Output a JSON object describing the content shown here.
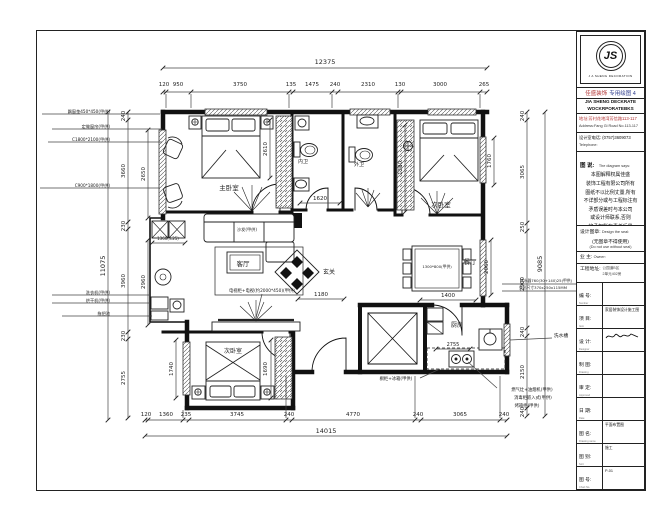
{
  "title_block": {
    "logo_initials": "JS",
    "logo_ring_text": "J A SHENG DECORATION",
    "brand_cn_a": "佳盛装饰",
    "brand_cn_b": "专用绘图 4",
    "brand_en1": "JIA SHENG DECKRATE",
    "brand_en2": "WOCKRPORATEBKS",
    "address_cn": "地址:芳村花地湾芳信路113-117",
    "address_en": "Address:Fang Gi Road No.113-117",
    "phone_cn": "设计室电话: (0757)3609073",
    "phone_en": "Telephone:",
    "notes_title_cn": "图 说:",
    "notes_title_en": "The diagram says:",
    "notes_lines": [
      "本图解释权属佳盛",
      "装饰工程有限公司所有",
      "图纸不以比例丈量,所有",
      "不详部分或与工程标注有",
      "矛盾误差时与本公司",
      "或设计师联系,否则",
      "将承担所有责任后果"
    ],
    "stamp_label": "设计图章:",
    "stamp_label_en": "Design the seal:",
    "stamp_center": "(无图章不得使用)",
    "stamp_center_en": "(Do not use without seal)",
    "owner_label": "业 主:",
    "owner_en": "Owner:",
    "site_label": "工程地址:",
    "site_lines": [
      "公园道B区",
      "2单元402房"
    ],
    "rows": [
      {
        "label": "编 号:",
        "en": "Number",
        "value": ""
      },
      {
        "label": "项 目:",
        "en": "Item",
        "value": "家居装饰设计施工图"
      },
      {
        "label": "设 计:",
        "en": "Designer",
        "value": "",
        "sig": true
      },
      {
        "label": "制 图:",
        "en": "Drawing",
        "value": ""
      },
      {
        "label": "审 定:",
        "en": "Approved",
        "value": ""
      },
      {
        "label": "日 期:",
        "en": "Date",
        "value": ""
      },
      {
        "label": "图 名:",
        "en": "Drawing name",
        "value": "平面布置图"
      },
      {
        "label": "图 别:",
        "en": "Sort",
        "value": "施工"
      },
      {
        "label": "图 号:",
        "en": "Chart No.",
        "value": "P-01"
      }
    ]
  },
  "plan": {
    "rooms": [
      "主卧室",
      "次卧室",
      "次卧室",
      "客厅",
      "餐厅",
      "厨房",
      "玄关",
      "内卫",
      "外卫"
    ],
    "texts": [
      {
        "t": "12375",
        "x": 325,
        "y": 64,
        "s": 6.5,
        "n": "dim-overall-top"
      },
      {
        "t": "120",
        "x": 164,
        "y": 86
      },
      {
        "t": "950",
        "x": 178,
        "y": 86
      },
      {
        "t": "3750",
        "x": 240,
        "y": 86
      },
      {
        "t": "135",
        "x": 291,
        "y": 86
      },
      {
        "t": "1475",
        "x": 312,
        "y": 86
      },
      {
        "t": "240",
        "x": 335,
        "y": 86
      },
      {
        "t": "2310",
        "x": 368,
        "y": 86
      },
      {
        "t": "130",
        "x": 400,
        "y": 86
      },
      {
        "t": "3000",
        "x": 440,
        "y": 86
      },
      {
        "t": "265",
        "x": 484,
        "y": 86
      },
      {
        "t": "14015",
        "x": 326,
        "y": 433,
        "s": 6.5,
        "n": "dim-overall-bottom"
      },
      {
        "t": "120",
        "x": 146,
        "y": 416
      },
      {
        "t": "1360",
        "x": 166,
        "y": 416
      },
      {
        "t": "235",
        "x": 186,
        "y": 416
      },
      {
        "t": "3745",
        "x": 237,
        "y": 416
      },
      {
        "t": "240",
        "x": 289,
        "y": 416
      },
      {
        "t": "4770",
        "x": 353,
        "y": 416
      },
      {
        "t": "240",
        "x": 418,
        "y": 416
      },
      {
        "t": "3065",
        "x": 460,
        "y": 416
      },
      {
        "t": "240",
        "x": 504,
        "y": 416
      },
      {
        "t": "11075",
        "x": 105,
        "y": 266,
        "r": -90,
        "s": 6.5,
        "n": "dim-overall-left"
      },
      {
        "t": "240",
        "x": 125,
        "y": 116,
        "r": -90
      },
      {
        "t": "3660",
        "x": 125,
        "y": 171,
        "r": -90
      },
      {
        "t": "230",
        "x": 125,
        "y": 226,
        "r": -90
      },
      {
        "t": "3960",
        "x": 125,
        "y": 281,
        "r": -90
      },
      {
        "t": "230",
        "x": 125,
        "y": 336,
        "r": -90
      },
      {
        "t": "2755",
        "x": 125,
        "y": 378,
        "r": -90
      },
      {
        "t": "2650",
        "x": 145,
        "y": 174,
        "r": -90
      },
      {
        "t": "2960",
        "x": 145,
        "y": 282,
        "r": -90
      },
      {
        "t": "9085",
        "x": 542,
        "y": 264,
        "r": -90,
        "s": 6.5,
        "n": "dim-overall-right"
      },
      {
        "t": "240",
        "x": 524,
        "y": 116,
        "r": -90
      },
      {
        "t": "3065",
        "x": 524,
        "y": 172,
        "r": -90
      },
      {
        "t": "250",
        "x": 524,
        "y": 227,
        "r": -90
      },
      {
        "t": "2900",
        "x": 524,
        "y": 284,
        "r": -90
      },
      {
        "t": "240",
        "x": 524,
        "y": 332,
        "r": -90
      },
      {
        "t": "2150",
        "x": 524,
        "y": 372,
        "r": -90
      },
      {
        "t": "240",
        "x": 524,
        "y": 412,
        "r": -90
      },
      {
        "t": "1760",
        "x": 491,
        "y": 161,
        "r": -90
      },
      {
        "t": "2060",
        "x": 488,
        "y": 267,
        "r": -90
      },
      {
        "t": "2610",
        "x": 267,
        "y": 149,
        "r": -90
      },
      {
        "t": "1380",
        "x": 402,
        "y": 168,
        "r": -90
      },
      {
        "t": "1620",
        "x": 320,
        "y": 200
      },
      {
        "t": "1180",
        "x": 321,
        "y": 296
      },
      {
        "t": "1400",
        "x": 448,
        "y": 297
      },
      {
        "t": "2755",
        "x": 453,
        "y": 346,
        "s": 5
      },
      {
        "t": "1740",
        "x": 173,
        "y": 369,
        "r": -90
      },
      {
        "t": "1690",
        "x": 267,
        "y": 369,
        "r": -90
      },
      {
        "t": "1360(±25)",
        "x": 168,
        "y": 240,
        "s": 4
      },
      {
        "t": "主卧室",
        "x": 229,
        "y": 190,
        "s": 6.5,
        "n": "room-label-master-bedroom"
      },
      {
        "t": "内卫",
        "x": 303,
        "y": 163,
        "s": 5,
        "n": "room-label-inner-bath"
      },
      {
        "t": "外卫",
        "x": 359,
        "y": 166,
        "s": 5,
        "n": "room-label-outer-bath"
      },
      {
        "t": "次卧室",
        "x": 441,
        "y": 207,
        "s": 6.5,
        "n": "room-label-second-bedroom"
      },
      {
        "t": "客厅",
        "x": 243,
        "y": 266,
        "s": 6.5,
        "n": "room-label-living-room"
      },
      {
        "t": "玄关",
        "x": 329,
        "y": 274,
        "s": 6,
        "n": "room-label-entry"
      },
      {
        "t": "餐厅",
        "x": 470,
        "y": 264,
        "s": 6.5,
        "n": "room-label-dining-room"
      },
      {
        "t": "次卧室",
        "x": 233,
        "y": 353,
        "s": 6,
        "n": "room-label-third-bedroom"
      },
      {
        "t": "厨房",
        "x": 457,
        "y": 327,
        "s": 6,
        "n": "room-label-kitchen"
      },
      {
        "t": "沙发(甲供)",
        "x": 247,
        "y": 231,
        "s": 4.2,
        "n": "sofa-note"
      },
      {
        "t": "1300*800(甲供)",
        "x": 437,
        "y": 268,
        "s": 3.8,
        "n": "dining-table-note"
      },
      {
        "t": "电视柜+电视(约2000*450)(甲供)",
        "x": 262,
        "y": 292,
        "s": 4.3,
        "n": "tv-note"
      },
      {
        "t": "橱柜+冰箱(甲供)",
        "x": 396,
        "y": 380,
        "s": 4.3,
        "n": "cabinet-fridge-note"
      },
      {
        "t": "燃气灶+油烟机(甲供)",
        "x": 532,
        "y": 391,
        "s": 4.3,
        "n": "stove-note"
      },
      {
        "t": "消毒柜嵌入式(甲供)",
        "x": 533,
        "y": 399,
        "s": 4.3,
        "n": "sterilizer-note"
      },
      {
        "t": "烤箱柜(甲供)",
        "x": 527,
        "y": 407,
        "s": 4.3,
        "n": "oven-note"
      },
      {
        "t": "热水器760(30+140)25(甲供)",
        "x": 546,
        "y": 282,
        "s": 3.8,
        "n": "water-heater-note"
      },
      {
        "t": "外形尺寸370x250x115MM",
        "x": 543,
        "y": 289,
        "s": 3.8,
        "n": "water-heater-size-note"
      },
      {
        "t": "洗水槽",
        "x": 561,
        "y": 337,
        "s": 4.8,
        "n": "sink-note"
      },
      {
        "t": "飘窗垫450*450(甲供)",
        "x": 110,
        "y": 113,
        "s": 4.2,
        "a": "e",
        "n": "bay-window-note"
      },
      {
        "t": "定做窗帘(甲供)",
        "x": 110,
        "y": 128,
        "s": 4.2,
        "a": "e",
        "n": "curtain-note"
      },
      {
        "t": "C1800*2100(甲供)",
        "x": 110,
        "y": 141,
        "s": 4.2,
        "a": "e",
        "n": "window-size-note"
      },
      {
        "t": "C900*1800(甲供)",
        "x": 110,
        "y": 187,
        "s": 4.2,
        "a": "e",
        "n": "window-size-note-2"
      },
      {
        "t": "洗衣机(甲供)",
        "x": 110,
        "y": 294,
        "s": 4.2,
        "a": "e",
        "n": "washer-note"
      },
      {
        "t": "烘干机(甲供)",
        "x": 110,
        "y": 302,
        "s": 4.2,
        "a": "e",
        "n": "dryer-note"
      },
      {
        "t": "拖把池",
        "x": 110,
        "y": 315,
        "s": 4.2,
        "a": "e",
        "n": "mop-pool-note"
      }
    ],
    "chains": [
      {
        "line": [
          163,
          68,
          487,
          68
        ],
        "ticks": [
          [
            163,
            68
          ],
          [
            487,
            68
          ]
        ]
      },
      {
        "line": [
          163,
          92,
          487,
          92
        ],
        "ticks": [
          [
            163,
            92
          ],
          [
            166,
            92
          ],
          [
            191,
            92
          ],
          [
            289,
            92
          ],
          [
            293,
            92
          ],
          [
            332,
            92
          ],
          [
            338,
            92
          ],
          [
            398,
            92
          ],
          [
            401,
            92
          ],
          [
            480,
            92
          ],
          [
            487,
            92
          ]
        ]
      },
      {
        "line": [
          145,
          420,
          507,
          420
        ],
        "ticks": [
          [
            145,
            420
          ],
          [
            148,
            420
          ],
          [
            183,
            420
          ],
          [
            189,
            420
          ],
          [
            286,
            420
          ],
          [
            292,
            420
          ],
          [
            415,
            420
          ],
          [
            421,
            420
          ],
          [
            500,
            420
          ],
          [
            507,
            420
          ]
        ]
      },
      {
        "line": [
          145,
          436,
          507,
          436
        ],
        "ticks": [
          [
            145,
            436
          ],
          [
            507,
            436
          ]
        ]
      },
      {
        "line": [
          108,
          112,
          108,
          420
        ],
        "ticks": [
          [
            108,
            112
          ],
          [
            108,
            420
          ]
        ]
      },
      {
        "line": [
          128,
          112,
          128,
          418
        ],
        "ticks": [
          [
            128,
            112
          ],
          [
            128,
            120
          ],
          [
            128,
            222
          ],
          [
            128,
            229
          ],
          [
            128,
            332
          ],
          [
            128,
            339
          ],
          [
            128,
            418
          ]
        ]
      },
      {
        "line": [
          148,
          130,
          148,
          218
        ],
        "ticks": [
          [
            148,
            130
          ],
          [
            148,
            218
          ]
        ]
      },
      {
        "line": [
          148,
          240,
          148,
          325
        ],
        "ticks": [
          [
            148,
            240
          ],
          [
            148,
            325
          ]
        ]
      },
      {
        "line": [
          527,
          112,
          527,
          416
        ],
        "ticks": [
          [
            527,
            112
          ],
          [
            527,
            120
          ],
          [
            527,
            223
          ],
          [
            527,
            231
          ],
          [
            527,
            328
          ],
          [
            527,
            336
          ],
          [
            527,
            408
          ],
          [
            527,
            416
          ]
        ]
      },
      {
        "line": [
          545,
          112,
          545,
          416
        ],
        "ticks": [
          [
            545,
            112
          ],
          [
            545,
            416
          ]
        ]
      },
      {
        "line": [
          494,
          138,
          494,
          185
        ],
        "ticks": [
          [
            494,
            138
          ],
          [
            494,
            185
          ]
        ]
      },
      {
        "line": [
          491,
          240,
          491,
          295
        ],
        "ticks": [
          [
            491,
            240
          ],
          [
            491,
            295
          ]
        ]
      },
      {
        "line": [
          270,
          120,
          270,
          178
        ],
        "ticks": [
          [
            270,
            120
          ],
          [
            270,
            178
          ]
        ]
      },
      {
        "line": [
          405,
          125,
          405,
          212
        ],
        "ticks": [
          [
            405,
            125
          ],
          [
            405,
            212
          ]
        ]
      },
      {
        "line": [
          176,
          340,
          176,
          398
        ],
        "ticks": [
          [
            176,
            340
          ],
          [
            176,
            398
          ]
        ]
      },
      {
        "line": [
          271,
          340,
          271,
          398
        ],
        "ticks": [
          [
            271,
            340
          ],
          [
            271,
            398
          ]
        ]
      },
      {
        "line": [
          300,
          203,
          340,
          203
        ],
        "ticks": [
          [
            300,
            203
          ],
          [
            340,
            203
          ]
        ]
      },
      {
        "line": [
          298,
          299,
          344,
          299
        ],
        "ticks": [
          [
            298,
            299
          ],
          [
            344,
            299
          ]
        ]
      },
      {
        "line": [
          420,
          300,
          476,
          300
        ],
        "ticks": [
          [
            420,
            300
          ],
          [
            476,
            300
          ]
        ]
      },
      {
        "line": [
          436,
          349,
          470,
          349
        ],
        "ticks": [
          [
            436,
            349
          ],
          [
            470,
            349
          ]
        ]
      },
      {
        "line": [
          152,
          243,
          185,
          243
        ],
        "ticks": [
          [
            152,
            243
          ],
          [
            185,
            243
          ]
        ]
      },
      {
        "line": [
          166,
          94,
          166,
          108
        ],
        "ticks": []
      },
      {
        "line": [
          191,
          94,
          191,
          108
        ],
        "ticks": []
      },
      {
        "line": [
          289,
          94,
          289,
          108
        ],
        "ticks": []
      },
      {
        "line": [
          332,
          94,
          332,
          108
        ],
        "ticks": []
      },
      {
        "line": [
          398,
          94,
          398,
          108
        ],
        "ticks": []
      },
      {
        "line": [
          480,
          94,
          480,
          108
        ],
        "ticks": []
      },
      {
        "line": [
          183,
          410,
          183,
          418
        ],
        "ticks": []
      },
      {
        "line": [
          286,
          376,
          286,
          418
        ],
        "ticks": []
      },
      {
        "line": [
          415,
          376,
          415,
          418
        ],
        "ticks": []
      },
      {
        "line": [
          500,
          376,
          500,
          418
        ],
        "ticks": []
      },
      {
        "line": [
          42,
          114,
          160,
          114
        ],
        "ticks": []
      },
      {
        "line": [
          52,
          129,
          162,
          129
        ],
        "ticks": []
      },
      {
        "line": [
          48,
          142,
          162,
          142
        ],
        "ticks": []
      },
      {
        "line": [
          40,
          188,
          160,
          188
        ],
        "ticks": []
      },
      {
        "line": [
          52,
          295,
          150,
          295
        ],
        "ticks": []
      },
      {
        "line": [
          52,
          303,
          150,
          303
        ],
        "ticks": []
      },
      {
        "line": [
          62,
          316,
          152,
          316
        ],
        "ticks": []
      },
      {
        "line": [
          262,
          294,
          256,
          318
        ],
        "ticks": []
      },
      {
        "line": [
          420,
          378,
          440,
          369
        ],
        "ticks": []
      },
      {
        "line": [
          497,
          388,
          468,
          362
        ],
        "ticks": []
      },
      {
        "line": [
          552,
          338,
          510,
          340
        ],
        "ticks": []
      },
      {
        "line": [
          502,
          284,
          590,
          284
        ],
        "ticks": []
      },
      {
        "line": [
          502,
          291,
          586,
          291
        ],
        "ticks": []
      }
    ]
  }
}
